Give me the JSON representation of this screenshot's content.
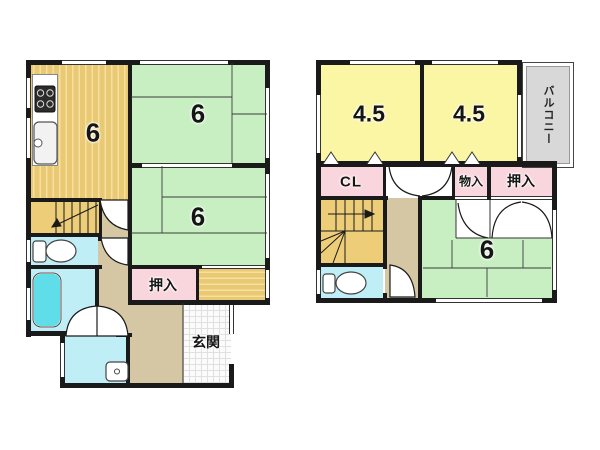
{
  "plan": {
    "type": "floor-plan",
    "floors": [
      {
        "name": "first-floor",
        "rooms": [
          {
            "id": "f1_kitchen",
            "label": "6",
            "kind": "kitchen-dining"
          },
          {
            "id": "f1_room_top",
            "label": "6",
            "kind": "tatami-room"
          },
          {
            "id": "f1_room_mid",
            "label": "6",
            "kind": "tatami-room"
          },
          {
            "id": "f1_oshiire",
            "label": "押入",
            "kind": "closet"
          },
          {
            "id": "f1_genkan",
            "label": "玄関",
            "kind": "entrance"
          }
        ]
      },
      {
        "name": "second-floor",
        "rooms": [
          {
            "id": "f2_room_left",
            "label": "4.5",
            "kind": "room"
          },
          {
            "id": "f2_room_right",
            "label": "4.5",
            "kind": "room"
          },
          {
            "id": "f2_balcony",
            "label": "バルコニー",
            "kind": "balcony"
          },
          {
            "id": "f2_cl",
            "label": "CL",
            "kind": "closet"
          },
          {
            "id": "f2_monoire",
            "label": "物入",
            "kind": "storage"
          },
          {
            "id": "f2_oshiire",
            "label": "押入",
            "kind": "closet"
          },
          {
            "id": "f2_room_tatami",
            "label": "6",
            "kind": "tatami-room"
          }
        ]
      }
    ]
  },
  "labels": {
    "f1_kitchen": "6",
    "f1_room_top": "6",
    "f1_room_mid": "6",
    "f1_oshiire": "押入",
    "f1_genkan": "玄関",
    "f2_room_left": "4.5",
    "f2_room_right": "4.5",
    "f2_balcony": "バルコニー",
    "f2_cl": "CL",
    "f2_monoire": "物入",
    "f2_oshiire": "押入",
    "f2_room_tatami": "6"
  },
  "colors": {
    "wall": "#1a1a1a",
    "tatami_green": "#c8efc2",
    "room_yellow": "#fbf6a3",
    "closet_pink": "#f9d6dd",
    "water_blue": "#bfeef7",
    "bathtub_cyan": "#5fdde9",
    "kitchen_tan": "#e9c973",
    "hall_tan": "#d5c6a4",
    "stairs_tan": "#eecd79",
    "balcony_gray": "#d8d8d8"
  }
}
